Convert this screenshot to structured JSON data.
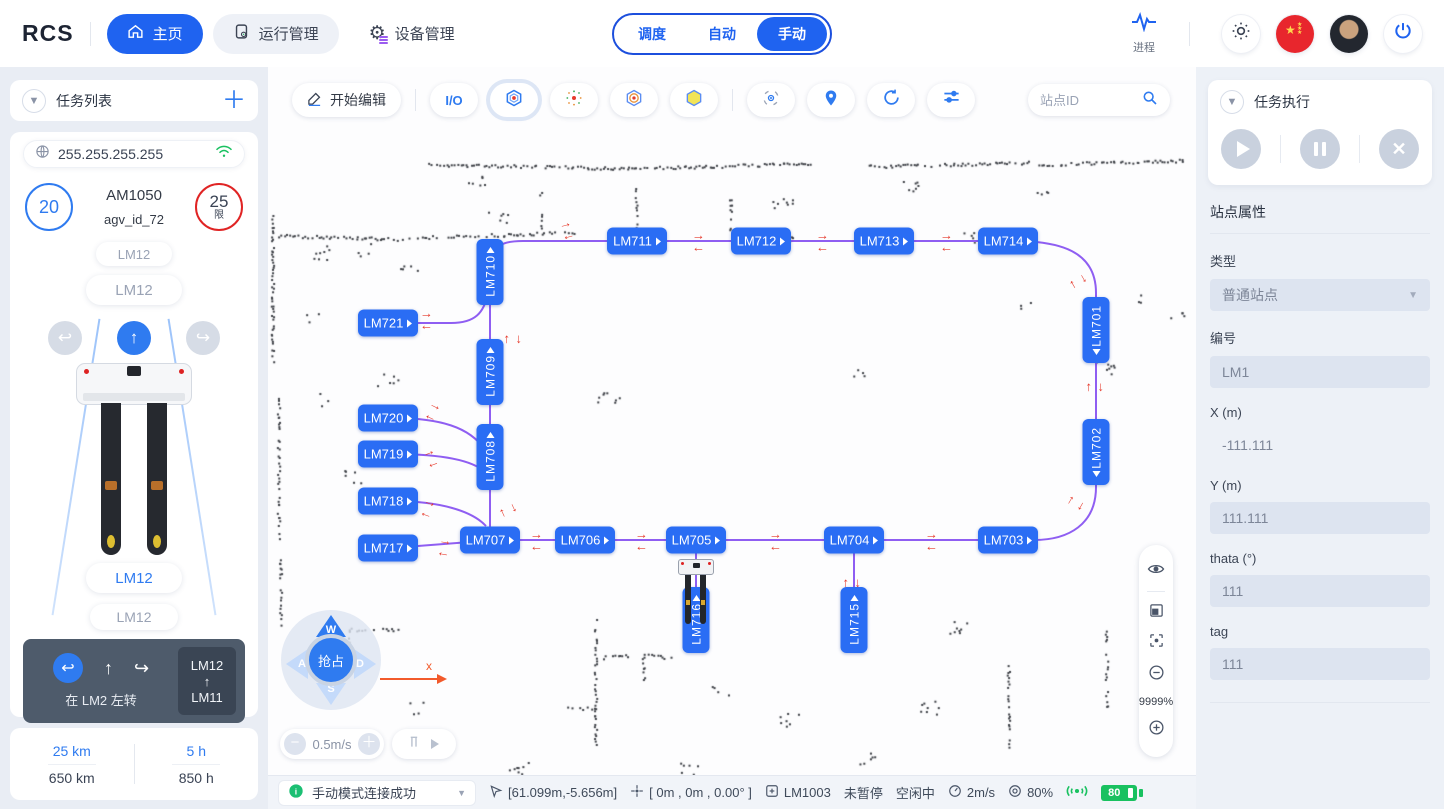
{
  "header": {
    "logo": "RCS",
    "nav": [
      {
        "label": "主页"
      },
      {
        "label": "运行管理"
      },
      {
        "label": "设备管理"
      }
    ],
    "mode_tabs": {
      "items": [
        "调度",
        "自动",
        "手动"
      ],
      "active": "手动"
    },
    "process_label": "进程"
  },
  "left": {
    "task_list_title": "任务列表",
    "vehicle": {
      "ip": "255.255.255.255",
      "speed_circle": "20",
      "limit_circle": "25",
      "limit_suffix": "限",
      "model": "AM1050",
      "agv_id": "agv_id_72",
      "badge_top_small": "LM12",
      "badge_top_large": "LM12",
      "badge_bottom_blue": "LM12",
      "badge_bottom_gray": "LM12",
      "nav_hint": "在 LM2 左转",
      "route_from": "LM12",
      "route_arrow": "↑",
      "route_to": "LM11",
      "stats": {
        "trip_distance": "25 km",
        "total_distance": "650 km",
        "trip_time": "5 h",
        "total_time": "850 h"
      }
    }
  },
  "map": {
    "toolbar": {
      "edit_label": "开始编辑",
      "io_label": "I/O",
      "search_placeholder": "站点ID"
    },
    "joystick": {
      "w": "W",
      "a": "A",
      "s": "S",
      "d": "D",
      "center": "抢占"
    },
    "axis_label": "x",
    "speed_value": "0.5m/s",
    "zoom_value": "9999%",
    "stations": [
      {
        "label": "LM710",
        "x": 222,
        "y": 205,
        "o": "v",
        "m": "top"
      },
      {
        "label": "LM711",
        "x": 369,
        "y": 174,
        "o": "h"
      },
      {
        "label": "LM712",
        "x": 493,
        "y": 174,
        "o": "h"
      },
      {
        "label": "LM713",
        "x": 616,
        "y": 174,
        "o": "h"
      },
      {
        "label": "LM714",
        "x": 740,
        "y": 174,
        "o": "h"
      },
      {
        "label": "LM701",
        "x": 828,
        "y": 263,
        "o": "v",
        "m": "bottom"
      },
      {
        "label": "LM721",
        "x": 120,
        "y": 256,
        "o": "h"
      },
      {
        "label": "LM709",
        "x": 222,
        "y": 305,
        "o": "v",
        "m": "top"
      },
      {
        "label": "LM720",
        "x": 120,
        "y": 351,
        "o": "h"
      },
      {
        "label": "LM719",
        "x": 120,
        "y": 387,
        "o": "h"
      },
      {
        "label": "LM708",
        "x": 222,
        "y": 390,
        "o": "v",
        "m": "top"
      },
      {
        "label": "LM718",
        "x": 120,
        "y": 434,
        "o": "h"
      },
      {
        "label": "LM717",
        "x": 120,
        "y": 481,
        "o": "h"
      },
      {
        "label": "LM707",
        "x": 222,
        "y": 473,
        "o": "h"
      },
      {
        "label": "LM706",
        "x": 317,
        "y": 473,
        "o": "h"
      },
      {
        "label": "LM705",
        "x": 428,
        "y": 473,
        "o": "h"
      },
      {
        "label": "LM704",
        "x": 586,
        "y": 473,
        "o": "h"
      },
      {
        "label": "LM703",
        "x": 740,
        "y": 473,
        "o": "h"
      },
      {
        "label": "LM702",
        "x": 828,
        "y": 385,
        "o": "v",
        "m": "bottom"
      },
      {
        "label": "LM716",
        "x": 428,
        "y": 553,
        "o": "v",
        "m": "top"
      },
      {
        "label": "LM715",
        "x": 586,
        "y": 553,
        "o": "v",
        "m": "top"
      }
    ]
  },
  "task_exec": {
    "title": "任务执行"
  },
  "station_props": {
    "title": "站点属性",
    "type_label": "类型",
    "type_value": "普通站点",
    "code_label": "编号",
    "code_value": "LM1",
    "x_label": "X (m)",
    "x_value": "-111.111",
    "y_label": "Y (m)",
    "y_value": "111.111",
    "theta_label": "thata (°)",
    "theta_value": "111",
    "tag_label": "tag",
    "tag_value": "111"
  },
  "status_bar": {
    "message": "手动模式连接成功",
    "position": "[61.099m,-5.656m]",
    "pose": "[ 0m , 0m , 0.00° ]",
    "station": "LM1003",
    "pause_state": "未暂停",
    "run_state": "空闲中",
    "speed": "2m/s",
    "percent": "80%",
    "battery": "80"
  },
  "colors": {
    "accent": "#1f63f0",
    "path": "#8f5ef2",
    "arrow": "#e63b2d",
    "green": "#19c160",
    "danger": "#e02424"
  }
}
